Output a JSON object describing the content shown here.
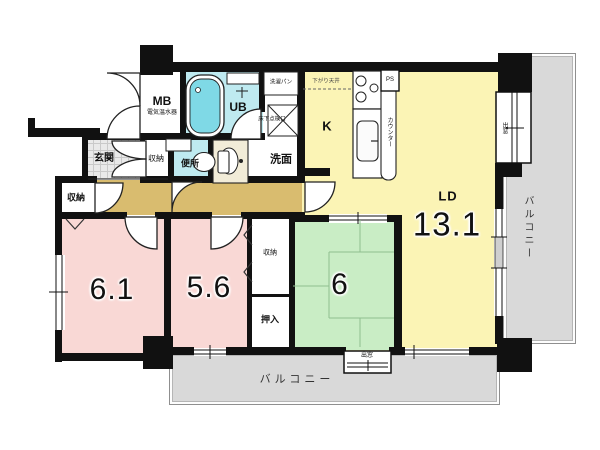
{
  "plan_type": "マンション間取り図",
  "rooms": {
    "ld": {
      "label": "LD",
      "area": "13.1"
    },
    "kitchen": {
      "label": "K"
    },
    "japanese_room": {
      "area": "6"
    },
    "western_room_1": {
      "area": "6.1"
    },
    "western_room_2": {
      "area": "5.6"
    },
    "genkan": {
      "label": "玄関"
    },
    "toilet": {
      "label": "便所"
    },
    "washroom": {
      "label": "洗面"
    },
    "unit_bath": {
      "label": "UB"
    },
    "meter_box": {
      "label": "MB",
      "sub": "電気温水器"
    },
    "storage_entry": {
      "label": "収納"
    },
    "storage_hall": {
      "label": "収納"
    },
    "storage_bedroom": {
      "label": "収納"
    },
    "oshiire": {
      "label": "押入"
    }
  },
  "annotations": {
    "counter": "カウンター",
    "ps": "PS",
    "laundry_pan": "洗濯パン",
    "floor_hatch": "床下点検口",
    "dropped_ceiling": "下がり天井",
    "bay_window_right": "出窓",
    "bay_window_bottom": "出窓",
    "balcony_right": "バルコニー",
    "balcony_bottom": "バルコニー"
  },
  "colors": {
    "wall": "#111111",
    "ldk_yellow": "#FBF4B5",
    "room_pink": "#F9D8D5",
    "tatami_green": "#C9EDC5",
    "wet_area_cyan": "#BFEAF0",
    "hall_tan": "#D9BC6F",
    "balcony_gray": "#D9D9D9",
    "bathtub_cyan": "#7FD9E6",
    "vanity_cream": "#F2ECD8"
  }
}
